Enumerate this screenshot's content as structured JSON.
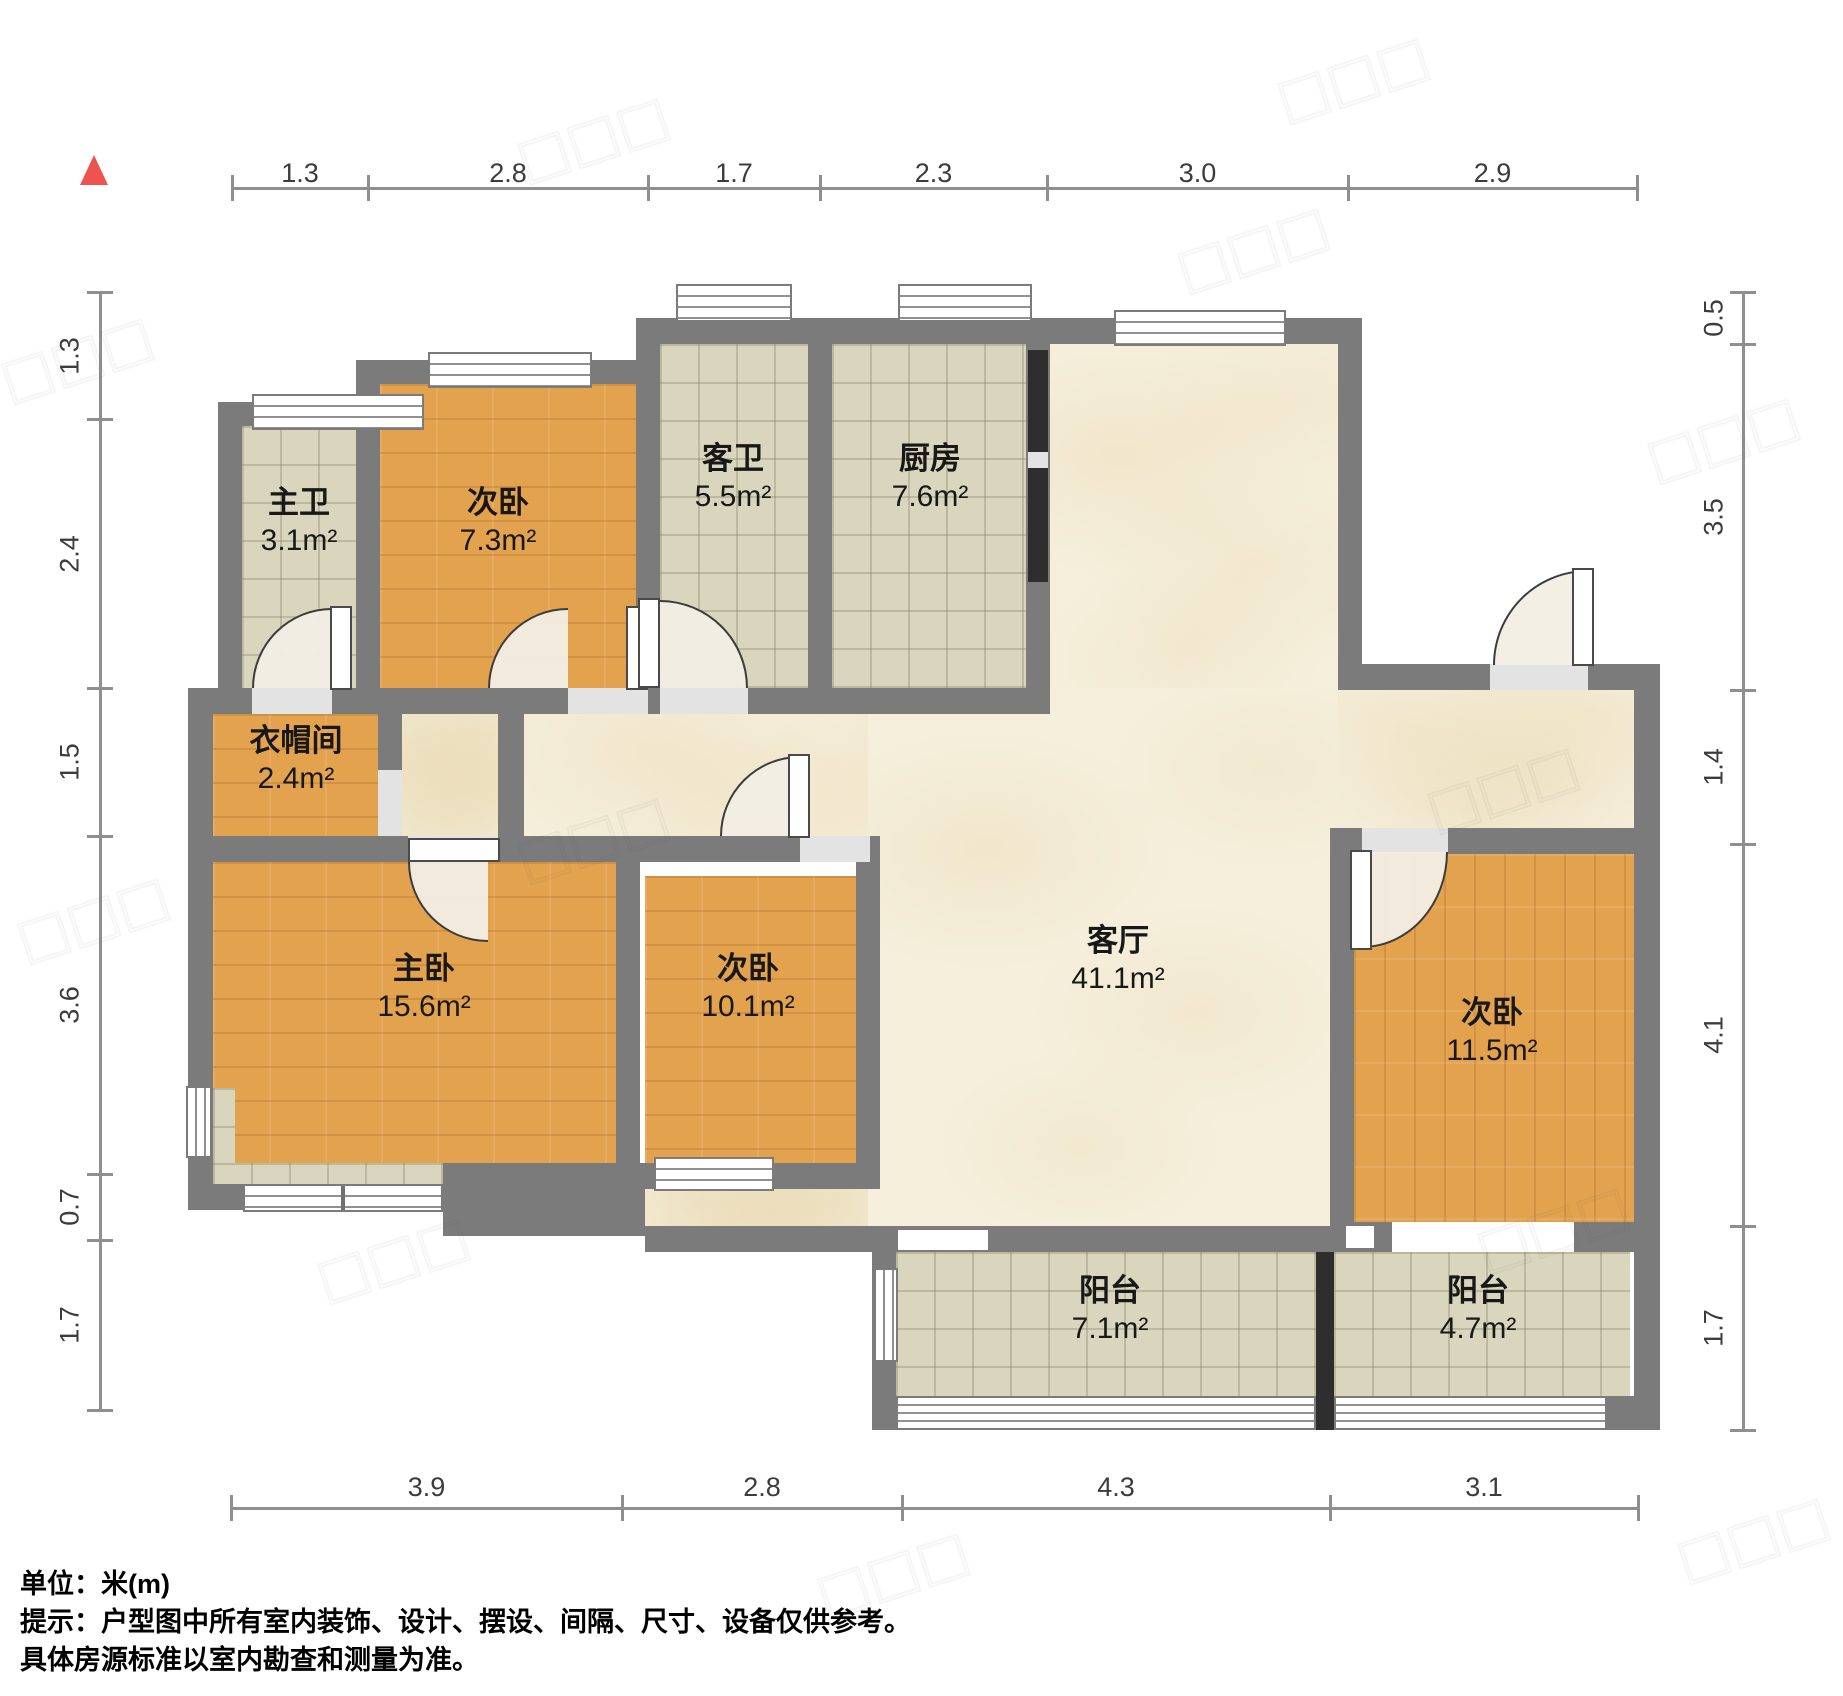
{
  "meta": {
    "unit_label": "单位：米(m)",
    "notice_line1": "提示：户型图中所有室内装饰、设计、摆设、间隔、尺寸、设备仅供参考。",
    "notice_line2": "具体房源标准以室内勘查和测量为准。"
  },
  "colors": {
    "wall": "#7b7b7b",
    "wood": "#e3a24e",
    "tile": "#d9d6bd",
    "marble": "#f5efdc",
    "black": "#2e2e2e",
    "north_arrow": "#ef5350",
    "dim": "#8f8f8f"
  },
  "rooms": [
    {
      "id": "zhuwei",
      "name": "主卫",
      "area": "3.1m²",
      "cx": 299,
      "cy": 484
    },
    {
      "id": "ciwo-7-3",
      "name": "次卧",
      "area": "7.3m²",
      "cx": 498,
      "cy": 484
    },
    {
      "id": "kewei",
      "name": "客卫",
      "area": "5.5m²",
      "cx": 733,
      "cy": 440
    },
    {
      "id": "chufang",
      "name": "厨房",
      "area": "7.6m²",
      "cx": 930,
      "cy": 440
    },
    {
      "id": "yimaojian",
      "name": "衣帽间",
      "area": "2.4m²",
      "cx": 296,
      "cy": 722
    },
    {
      "id": "zhuwo",
      "name": "主卧",
      "area": "15.6m²",
      "cx": 424,
      "cy": 950
    },
    {
      "id": "ciwo-10-1",
      "name": "次卧",
      "area": "10.1m²",
      "cx": 748,
      "cy": 950
    },
    {
      "id": "keting",
      "name": "客厅",
      "area": "41.1m²",
      "cx": 1118,
      "cy": 922
    },
    {
      "id": "ciwo-11-5",
      "name": "次卧",
      "area": "11.5m²",
      "cx": 1492,
      "cy": 994
    },
    {
      "id": "yangtai-7-1",
      "name": "阳台",
      "area": "7.1m²",
      "cx": 1110,
      "cy": 1272
    },
    {
      "id": "yangtai-4-7",
      "name": "阳台",
      "area": "4.7m²",
      "cx": 1478,
      "cy": 1272
    }
  ],
  "dimensions": {
    "top": {
      "labels": [
        "1.3",
        "2.8",
        "1.7",
        "2.3",
        "3.0",
        "2.9"
      ]
    },
    "bottom": {
      "labels": [
        "3.9",
        "2.8",
        "4.3",
        "3.1"
      ]
    },
    "left": {
      "labels": [
        "1.3",
        "2.4",
        "1.5",
        "3.6",
        "0.7",
        "1.7"
      ]
    },
    "right": {
      "labels": [
        "0.5",
        "3.5",
        "1.4",
        "4.1",
        "1.7"
      ]
    }
  }
}
